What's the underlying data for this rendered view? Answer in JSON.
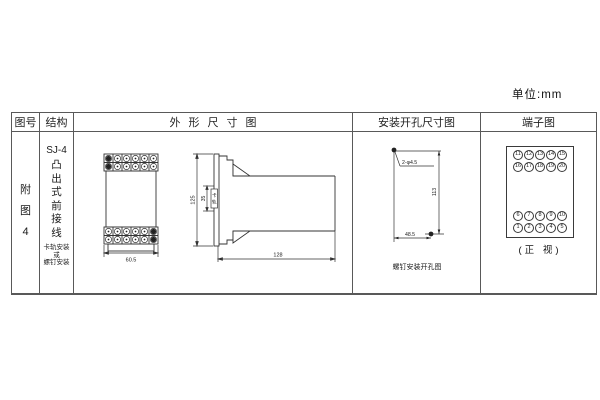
{
  "unit_label": "单位:mm",
  "table": {
    "headers": [
      "图号",
      "结构",
      "外形尺寸图",
      "安装开孔尺寸图",
      "端子图"
    ]
  },
  "figure_no": {
    "chars": [
      "附",
      "图",
      "4"
    ]
  },
  "structure": {
    "model": "SJ-4",
    "type_chars": [
      "凸",
      "出",
      "式",
      "前",
      "接",
      "线"
    ],
    "mount_lines": [
      "卡轨安装",
      "或",
      "螺钉安装"
    ]
  },
  "outline": {
    "front_width": "60.5",
    "side_height": "125",
    "rail_width": "35",
    "rail_chars": [
      "卡",
      "轨"
    ],
    "depth": "128"
  },
  "install": {
    "hole_label": "2-φ4.5",
    "vertical_dim": "113",
    "horizontal_dim": "48.5",
    "caption": "螺钉安装开孔图"
  },
  "terminal": {
    "top_rows": [
      [
        "11",
        "12",
        "13",
        "14",
        "15"
      ],
      [
        "16",
        "17",
        "18",
        "19",
        "20"
      ]
    ],
    "bottom_rows": [
      [
        "6",
        "7",
        "8",
        "9",
        "10"
      ],
      [
        "1",
        "2",
        "3",
        "4",
        "5"
      ]
    ],
    "caption": "(正 视)"
  }
}
